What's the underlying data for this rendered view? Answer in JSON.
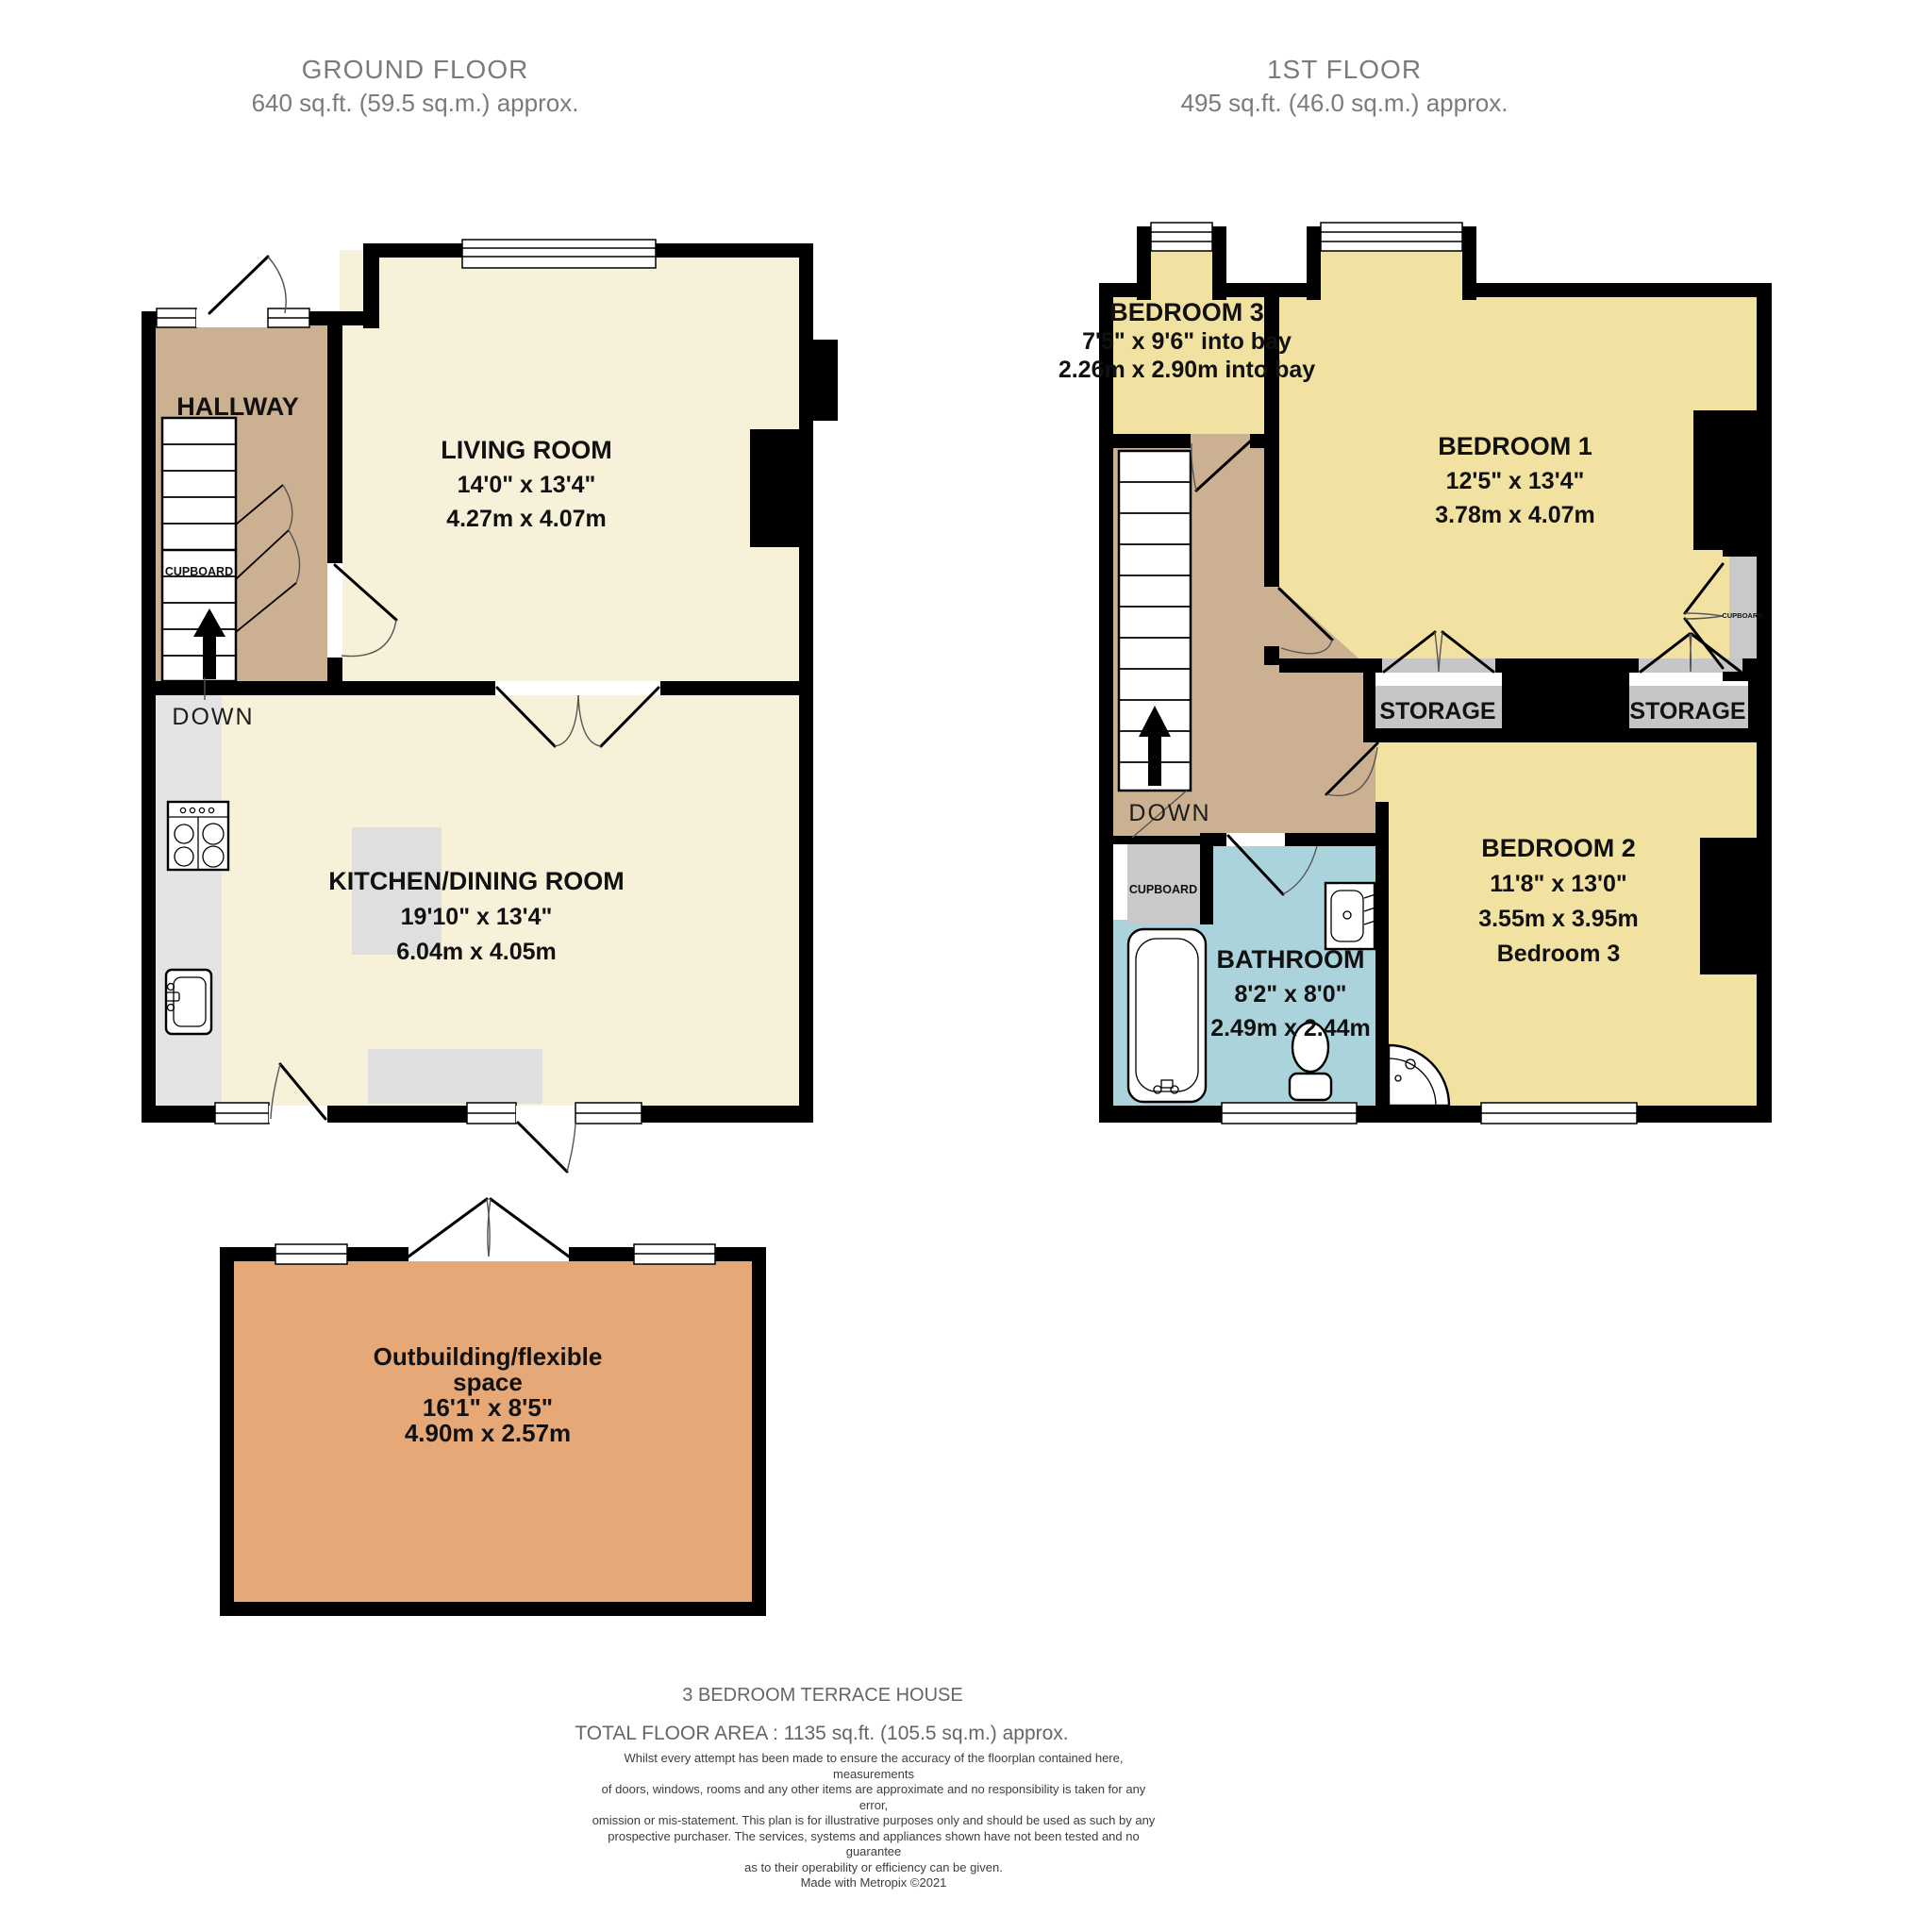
{
  "ground_floor": {
    "title": "GROUND FLOOR",
    "subtitle": "640 sq.ft. (59.5 sq.m.) approx.",
    "rooms": {
      "hallway": {
        "name": "HALLWAY"
      },
      "living": {
        "name": "LIVING ROOM",
        "dims_imperial": "14'0\"  x 13'4\"",
        "dims_metric": "4.27m  x 4.07m"
      },
      "kitchen": {
        "name": "KITCHEN/DINING ROOM",
        "dims_imperial": "19'10\"  x 13'4\"",
        "dims_metric": "6.04m  x 4.05m"
      }
    },
    "labels": {
      "cupboard": "CUPBOARD",
      "down": "DOWN"
    }
  },
  "first_floor": {
    "title": "1ST FLOOR",
    "subtitle": "495 sq.ft. (46.0 sq.m.) approx.",
    "rooms": {
      "bedroom3": {
        "name": "BEDROOM 3",
        "dims_imperial": "7'5\"  x 9'6\" into bay",
        "dims_metric": "2.26m  x 2.90m into bay"
      },
      "bedroom1": {
        "name": "BEDROOM 1",
        "dims_imperial": "12'5\"  x 13'4\"",
        "dims_metric": "3.78m  x 4.07m"
      },
      "bedroom2": {
        "name": "BEDROOM 2",
        "dims_imperial": "11'8\"  x 13'0\"",
        "dims_metric": "3.55m  x 3.95m",
        "note": "Bedroom 3"
      },
      "bathroom": {
        "name": "BATHROOM",
        "dims_imperial": "8'2\"  x 8'0\"",
        "dims_metric": "2.49m  x 2.44m"
      }
    },
    "labels": {
      "down": "DOWN",
      "cupboard": "CUPBOARD",
      "cupboard_small": "CUPBOARD",
      "storage_left": "STORAGE",
      "storage_right": "STORAGE"
    }
  },
  "outbuilding": {
    "name_line1": "Outbuilding/flexible",
    "name_line2": "space",
    "dims_imperial": "16'1\"  x 8'5\"",
    "dims_metric": "4.90m  x 2.57m"
  },
  "footer": {
    "property_type": "3 BEDROOM TERRACE HOUSE",
    "total_area": "TOTAL FLOOR AREA : 1135 sq.ft. (105.5 sq.m.) approx.",
    "disclaimer_lines": [
      "Whilst every attempt has been made to ensure the accuracy of the floorplan contained here, measurements",
      "of doors, windows, rooms and any other items are approximate and no responsibility is taken for any error,",
      "omission or mis-statement. This plan is for illustrative purposes only and should be used as such by any",
      "prospective purchaser. The services, systems and appliances shown have not been tested and no guarantee",
      "as to their operability or efficiency can be given.",
      "Made with Metropix ©2021"
    ]
  },
  "colors": {
    "wall": "#000000",
    "cream": "#f7f1da",
    "tan": "#cbb191",
    "yellow": "#f2e2a2",
    "blue": "#aad3dc",
    "orange": "#e6a877",
    "storage_gray": "#c6c6c6",
    "counter_gray": "#e4e4e4",
    "furniture_gray": "#dfdfdf",
    "cupboard_gray": "#c9c9c9",
    "title_gray": "#7b7b7b"
  }
}
